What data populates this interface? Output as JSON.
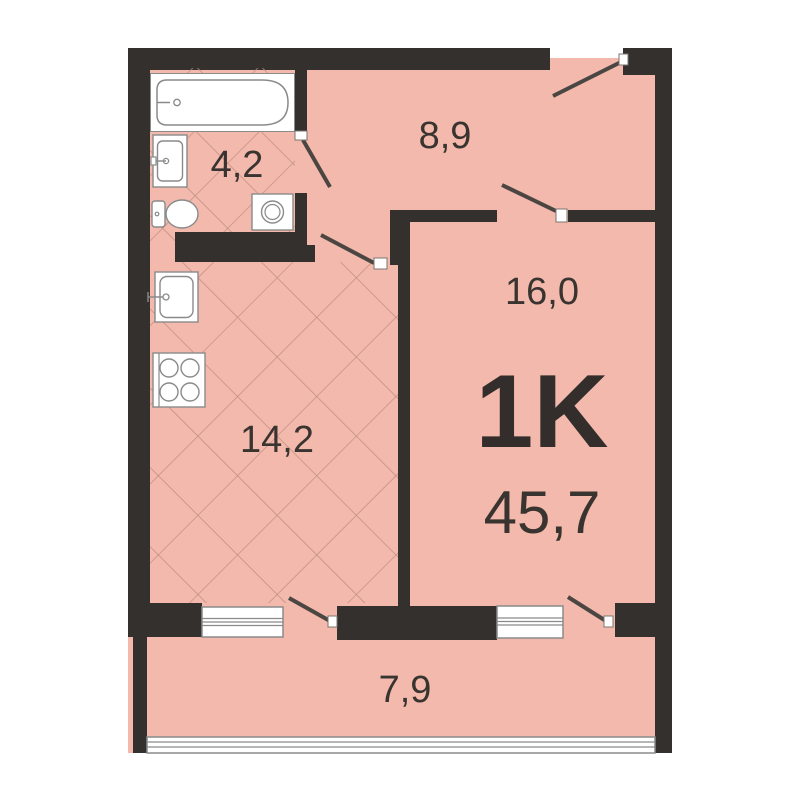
{
  "plan": {
    "type_label": "1K",
    "total_area": "45,7",
    "rooms": {
      "bathroom": {
        "area": "4,2"
      },
      "hallway": {
        "area": "8,9"
      },
      "living_room": {
        "area": "16,0"
      },
      "kitchen": {
        "area": "14,2"
      },
      "balcony": {
        "area": "7,9"
      }
    },
    "colors": {
      "floor_fill": "#f2b9ac",
      "wall": "#34302e",
      "tile_line": "#c18d81",
      "fixture_outline": "#8a8a8a",
      "door_swing": "#4c4642",
      "text": "#3a3430"
    }
  }
}
